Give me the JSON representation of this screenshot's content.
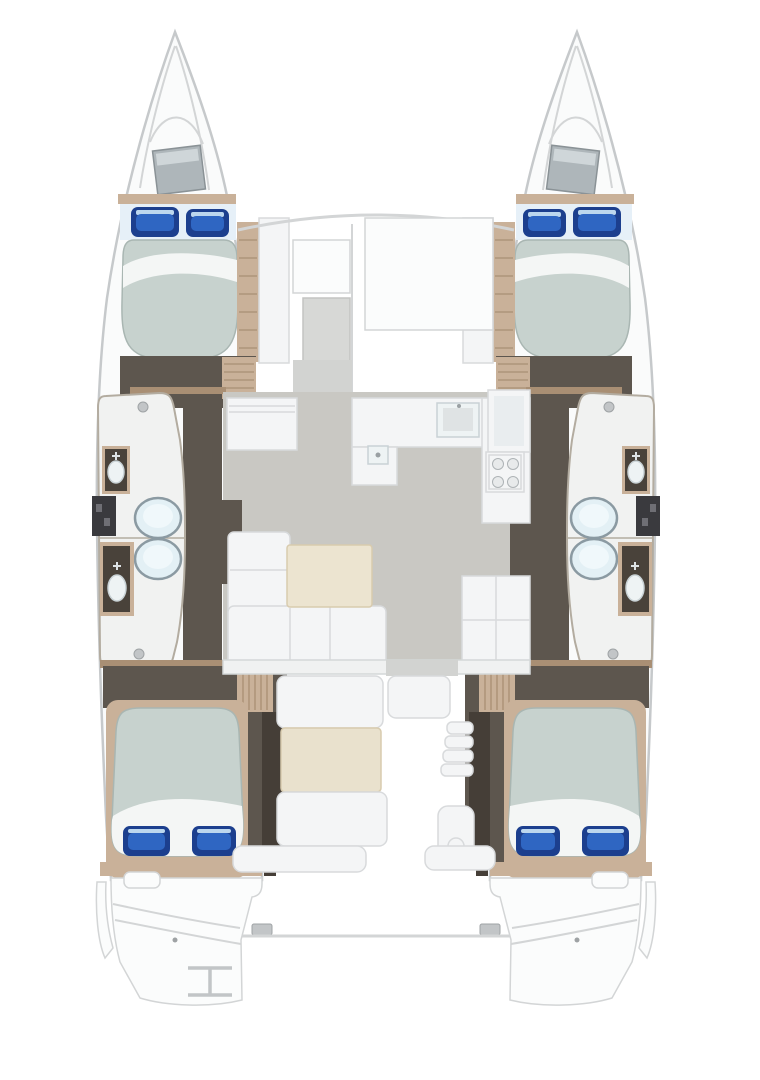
{
  "page": {
    "title": "Catamaran yacht deck plan — 4-cabin layout"
  },
  "plan": {
    "vessel_type": "catamaran",
    "view": "top-down interior floor plan",
    "double_cabins": 4,
    "bathrooms": 4,
    "toilets": 4,
    "washbasins": 4,
    "shower_boxes": 2,
    "bow_hatches": 2,
    "areas": [
      {
        "id": "bow-locker-port",
        "label": "Port bow locker"
      },
      {
        "id": "bow-locker-starboard",
        "label": "Starboard bow locker"
      },
      {
        "id": "foredeck",
        "label": "Foredeck"
      },
      {
        "id": "cabin-forward-port",
        "label": "Forward double cabin (port)"
      },
      {
        "id": "cabin-forward-starboard",
        "label": "Forward double cabin (starboard)"
      },
      {
        "id": "bathroom-forward-port",
        "label": "Forward bathroom (port)"
      },
      {
        "id": "bathroom-aft-port",
        "label": "Aft bathroom (port)"
      },
      {
        "id": "bathroom-forward-starboard",
        "label": "Forward bathroom (starboard)"
      },
      {
        "id": "bathroom-aft-starboard",
        "label": "Aft bathroom (starboard)"
      },
      {
        "id": "saloon",
        "label": "Saloon with sofa and table"
      },
      {
        "id": "galley",
        "label": "Galley with sink and stove"
      },
      {
        "id": "cabin-aft-port",
        "label": "Aft double cabin (port)"
      },
      {
        "id": "cabin-aft-starboard",
        "label": "Aft double cabin (starboard)"
      },
      {
        "id": "cockpit",
        "label": "Aft cockpit with bench seating and table"
      },
      {
        "id": "transom-port",
        "label": "Port transom swim platform"
      },
      {
        "id": "transom-starboard",
        "label": "Starboard transom swim platform"
      },
      {
        "id": "boarding-ladder",
        "label": "Boarding ladder"
      }
    ]
  },
  "colors": {
    "canvas": "#ffffff",
    "hull_fill": "#fafbfb",
    "hull_line": "#c6c9cb",
    "deck_line": "#d3d5d6",
    "deck_panel": "#fbfcfc",
    "foredeck_hatch": "#d7d8d6",
    "wood_floor": "#5d564e",
    "wood_dark": "#453e37",
    "trim_beige": "#c9b199",
    "trim_beige_dark": "#a98f74",
    "mattress": "#c7d2ce",
    "mattress_line": "#a9b6b2",
    "sheet_white": "#f4f6f5",
    "bed_head": "#e6f0f8",
    "pillow_navy": "#1c3f8e",
    "pillow_blue": "#2f66c2",
    "pillow_sheen": "#bcd7ee",
    "bath_white": "#f1f2f1",
    "bath_line": "#b3aca0",
    "toilet_fill": "#e3f0f5",
    "toilet_inner": "#f0f8fb",
    "toilet_line": "#8b9aa2",
    "shower_dark": "#3a3a3e",
    "counter_dark": "#49423a",
    "sink_white": "#eef3f4",
    "sink_line": "#c9d2d5",
    "saloon_floor": "#c9c8c3",
    "walkway_gray": "#d2d3d1",
    "furniture_white": "#f4f5f6",
    "furniture_line": "#d8dadc",
    "table_cream": "#ece4d0",
    "table_line": "#d8cbae",
    "cockpit_table": "#e9e1cd",
    "metal_gray": "#c2c5c7",
    "hatch_gray": "#aeb6ba",
    "hatch_gray_light": "#cfd6d9",
    "hatch_gray_line": "#8a9296"
  }
}
